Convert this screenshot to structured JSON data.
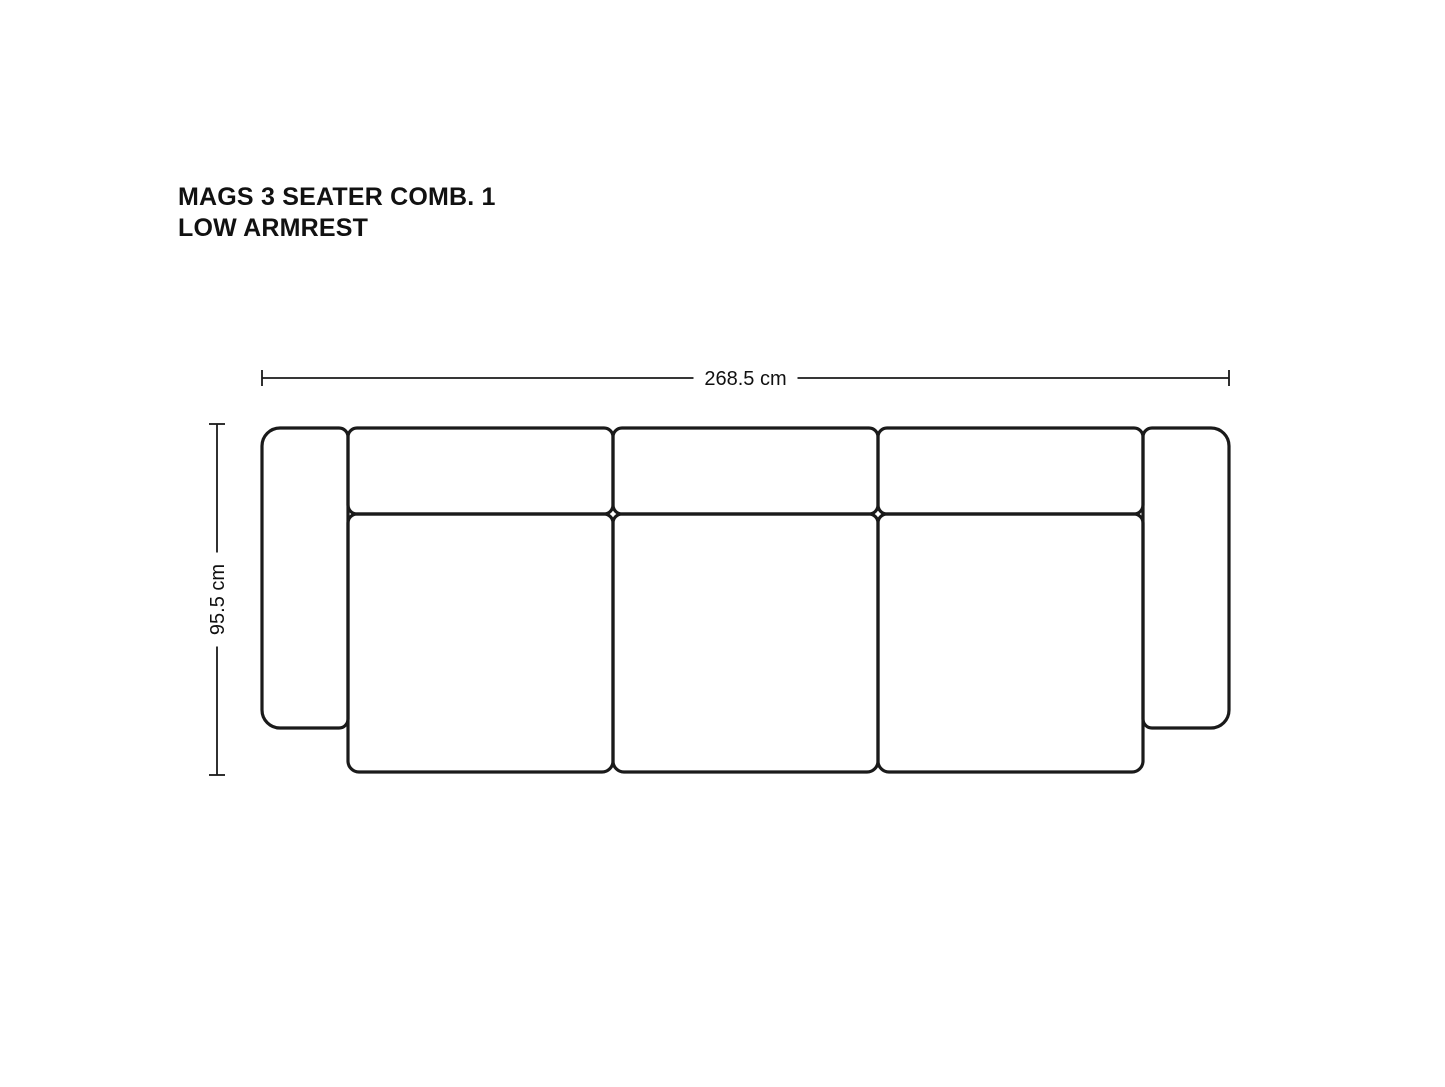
{
  "title": {
    "line1": "MAGS 3 SEATER COMB. 1",
    "line2": "LOW ARMREST"
  },
  "diagram": {
    "type": "sofa-top-view-technical-drawing",
    "product": "MAGS 3 Seater Comb. 1 Low Armrest",
    "colors": {
      "outline": "#1a1a1a",
      "dimension_line": "#1a1a1a",
      "text": "#111111",
      "background": "#ffffff"
    },
    "stroke": {
      "outline_width": 3.2,
      "dimension_width": 1.8,
      "tick_length": 16
    },
    "dimensions": {
      "width": {
        "label": "268.5 cm",
        "value_cm": 268.5,
        "orientation": "horizontal",
        "x1": 262,
        "x2": 1229,
        "y": 378,
        "label_gap": 104
      },
      "depth": {
        "label": "95.5 cm",
        "value_cm": 95.5,
        "orientation": "vertical",
        "y1": 424,
        "y2": 775,
        "x": 217,
        "label_gap": 94
      }
    },
    "parts": [
      {
        "name": "left-armrest",
        "x": 262,
        "y": 428,
        "w": 86,
        "h": 300,
        "r": [
          18,
          9,
          9,
          18
        ]
      },
      {
        "name": "back-cushion-1",
        "x": 348,
        "y": 428,
        "w": 265,
        "h": 86,
        "r": [
          9,
          9,
          9,
          9
        ]
      },
      {
        "name": "back-cushion-2",
        "x": 613,
        "y": 428,
        "w": 265,
        "h": 86,
        "r": [
          9,
          9,
          9,
          9
        ]
      },
      {
        "name": "back-cushion-3",
        "x": 878,
        "y": 428,
        "w": 265,
        "h": 86,
        "r": [
          9,
          9,
          9,
          9
        ]
      },
      {
        "name": "seat-cushion-1",
        "x": 348,
        "y": 514,
        "w": 265,
        "h": 258,
        "r": [
          9,
          9,
          11,
          11
        ]
      },
      {
        "name": "seat-cushion-2",
        "x": 613,
        "y": 514,
        "w": 265,
        "h": 258,
        "r": [
          9,
          9,
          11,
          11
        ]
      },
      {
        "name": "seat-cushion-3",
        "x": 878,
        "y": 514,
        "w": 265,
        "h": 258,
        "r": [
          9,
          9,
          11,
          11
        ]
      },
      {
        "name": "right-armrest",
        "x": 1143,
        "y": 428,
        "w": 86,
        "h": 300,
        "r": [
          9,
          18,
          18,
          9
        ]
      }
    ]
  }
}
